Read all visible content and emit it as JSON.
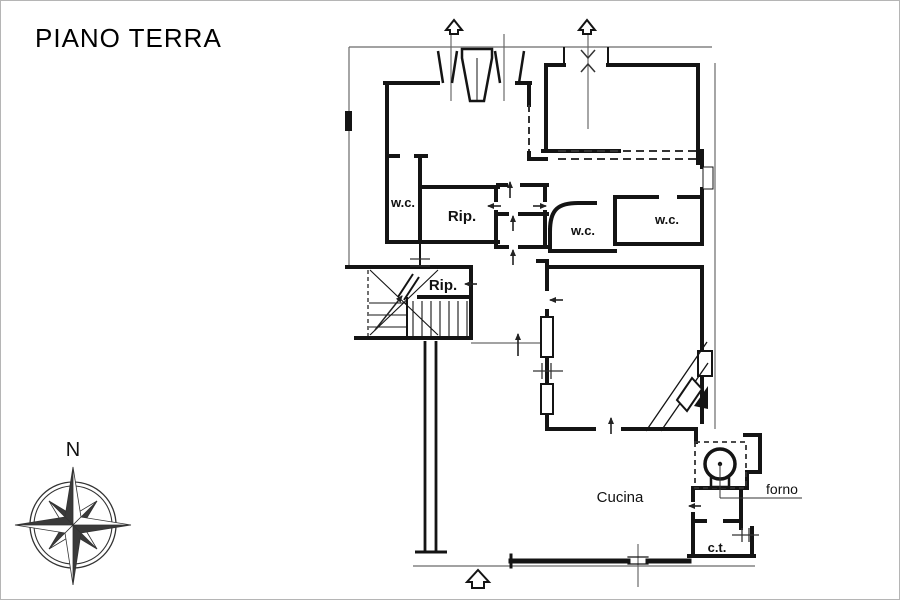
{
  "page": {
    "title": "PIANO TERRA"
  },
  "compass": {
    "label": "N"
  },
  "plan": {
    "labels": {
      "wc1": "w.c.",
      "rip1": "Rip.",
      "wc2": "w.c.",
      "wc3": "w.c.",
      "rip2": "Rip.",
      "kitchen": "Cucina",
      "oven": "forno",
      "boiler": "c.t."
    },
    "colors": {
      "wall": "#141414",
      "thin_line": "#6a6a6a",
      "dashed": "#333333",
      "background": "#ffffff"
    }
  }
}
